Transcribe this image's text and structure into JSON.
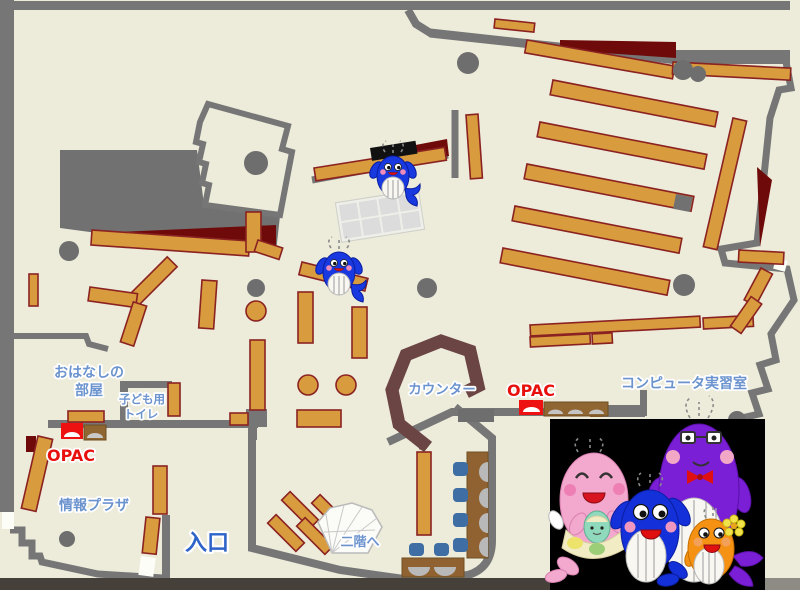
{
  "map": {
    "type": "library-floor-map",
    "areas": {
      "story_room": {
        "label_line1": "おはなしの",
        "label_line2": "部屋"
      },
      "kids_toilet": {
        "label_line1": "子ども用",
        "label_line2": "トイレ"
      },
      "info_plaza": {
        "label": "情報プラザ"
      },
      "entrance": {
        "label": "入口"
      },
      "stairs": {
        "label": "二階へ"
      },
      "counter": {
        "label": "カウンター"
      },
      "computer_room": {
        "label": "コンピュータ実習室"
      },
      "opac_left": {
        "label": "OPAC"
      },
      "opac_right": {
        "label": "OPAC"
      }
    },
    "colors": {
      "floor": "#EDEBDA",
      "wall": "#767676",
      "shelf": "#D89B3E",
      "shelf_border": "#8B2222",
      "dark_red_area": "#6E0A0A",
      "counter_brown": "#6B4444",
      "desk_brown": "#916231",
      "chair_blue": "#3E6EA4",
      "label_blue": "#6B93CE",
      "entrance_blue": "#2E64C8",
      "opac_red": "#E8100C",
      "photo_background": "#000000",
      "whale_blue": "#1838E0",
      "whale_pink": "#F3A8CE",
      "whale_purple": "#7A1FD6",
      "whale_orange": "#F59214",
      "whale_baby_mint": "#8FD9BC"
    },
    "mascots": {
      "on_map": "two small blue whale mascots",
      "photo": "whale mascot family: pink mother with mint baby, blue child, purple father with glasses and red bow, orange child with flower"
    }
  }
}
